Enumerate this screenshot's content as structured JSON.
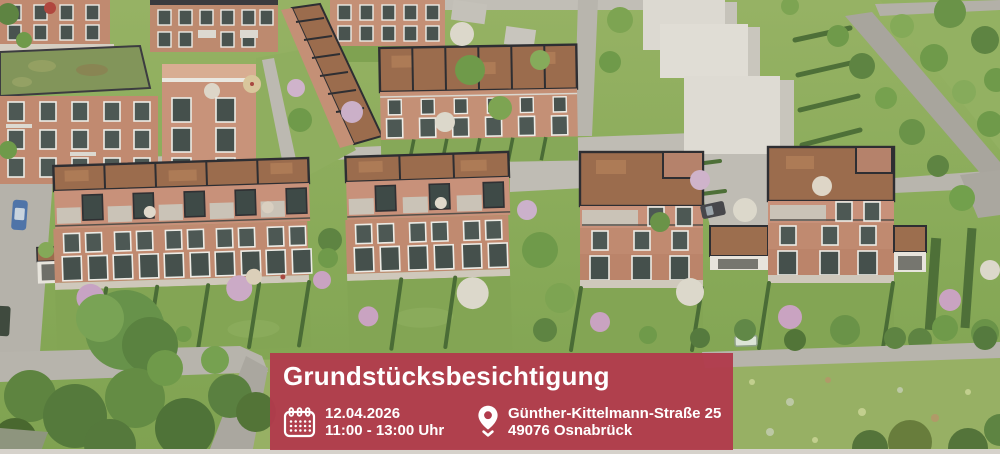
{
  "banner": {
    "accent_color": "#b13b4c",
    "text_color": "#ffffff",
    "title": "Grundstücksbesichtigung",
    "date_item": {
      "icon": "calendar-icon",
      "date": "12.04.2026",
      "time": "11:00 - 13:00 Uhr"
    },
    "location_item": {
      "icon": "location-pin-icon",
      "street": "Günther-Kittelmann-Straße 25",
      "city": "49076 Osnabrück"
    }
  },
  "scene": {
    "type": "aerial-architectural-rendering",
    "description": "Aerial 3D rendering of a residential quarter: brick townhouse rows with roof terraces, detached brick houses with garages, private gardens with hedges and blossom trees, grey paths, a wildflower meadow and untextured placeholder building volumes"
  }
}
